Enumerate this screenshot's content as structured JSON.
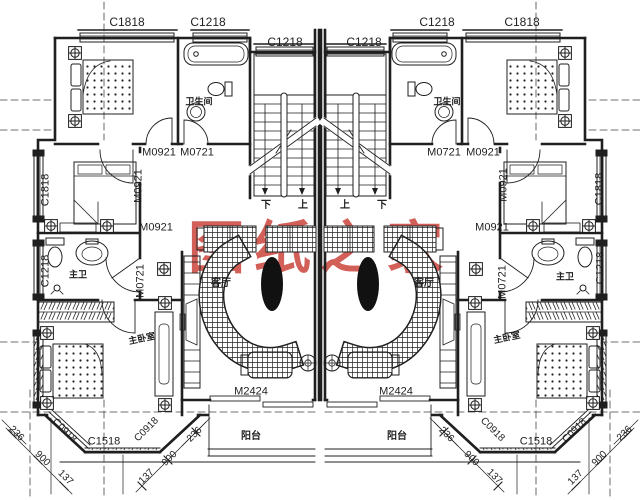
{
  "title": "二层双拼别墅户型平面图",
  "colors": {
    "line": "#1f1f1f",
    "watermark": "#c8392f",
    "background": "#ffffff"
  },
  "annotations": {
    "watermark": [
      {
        "name": "watermark-text",
        "text": "图纸之家",
        "x": 320,
        "y": 249,
        "size": 57,
        "color": "#c8392f",
        "cls": "wm"
      }
    ],
    "windows": [
      {
        "name": "window-code",
        "text": "C1818",
        "x": 127,
        "y": 22,
        "size": 12,
        "cls": "code"
      },
      {
        "name": "window-code",
        "text": "C1218",
        "x": 208,
        "y": 22,
        "size": 12,
        "cls": "code"
      },
      {
        "name": "window-code",
        "text": "C1218",
        "x": 285,
        "y": 42,
        "size": 12,
        "cls": "code"
      },
      {
        "name": "window-code",
        "text": "C1218",
        "x": 364,
        "y": 42,
        "size": 12,
        "cls": "code"
      },
      {
        "name": "window-code",
        "text": "C1218",
        "x": 437,
        "y": 22,
        "size": 12,
        "cls": "code"
      },
      {
        "name": "window-code",
        "text": "C1818",
        "x": 522,
        "y": 22,
        "size": 12,
        "cls": "code"
      },
      {
        "name": "window-code",
        "text": "C1818",
        "x": 46,
        "y": 190,
        "size": 11,
        "rot": -90,
        "cls": "code"
      },
      {
        "name": "window-code",
        "text": "C1818",
        "x": 600,
        "y": 189,
        "size": 11,
        "rot": -90,
        "cls": "code"
      },
      {
        "name": "window-code",
        "text": "C1218",
        "x": 46,
        "y": 271,
        "size": 11,
        "rot": -90,
        "cls": "code"
      },
      {
        "name": "window-code",
        "text": "C1218",
        "x": 601,
        "y": 268,
        "size": 11,
        "rot": -90,
        "cls": "code"
      },
      {
        "name": "window-code",
        "text": "C0918",
        "x": 64,
        "y": 431,
        "size": 10,
        "rot": 45,
        "cls": "code"
      },
      {
        "name": "window-code",
        "text": "C1518",
        "x": 104,
        "y": 442,
        "size": 11,
        "cls": "code"
      },
      {
        "name": "window-code",
        "text": "C0918",
        "x": 147,
        "y": 430,
        "size": 10,
        "rot": -45,
        "cls": "code"
      },
      {
        "name": "window-code",
        "text": "C0918",
        "x": 492,
        "y": 430,
        "size": 10,
        "rot": 45,
        "cls": "code"
      },
      {
        "name": "window-code",
        "text": "C1518",
        "x": 536,
        "y": 442,
        "size": 11,
        "cls": "code"
      },
      {
        "name": "window-code",
        "text": "C0918",
        "x": 575,
        "y": 431,
        "size": 10,
        "rot": -45,
        "cls": "code"
      }
    ],
    "doors": [
      {
        "name": "door-code",
        "text": "M0921",
        "x": 159,
        "y": 153,
        "size": 11,
        "cls": "code"
      },
      {
        "name": "door-code",
        "text": "M0721",
        "x": 197,
        "y": 153,
        "size": 11,
        "cls": "code"
      },
      {
        "name": "door-code",
        "text": "M0721",
        "x": 444,
        "y": 153,
        "size": 11,
        "cls": "code"
      },
      {
        "name": "door-code",
        "text": "M0921",
        "x": 483,
        "y": 153,
        "size": 11,
        "cls": "code"
      },
      {
        "name": "door-code",
        "text": "M0921",
        "x": 139,
        "y": 186,
        "size": 11,
        "rot": -90,
        "cls": "code"
      },
      {
        "name": "door-code",
        "text": "M0921",
        "x": 504,
        "y": 185,
        "size": 11,
        "rot": -90,
        "cls": "code"
      },
      {
        "name": "door-code",
        "text": "M0921",
        "x": 156,
        "y": 228,
        "size": 11,
        "cls": "code"
      },
      {
        "name": "door-code",
        "text": "M0921",
        "x": 492,
        "y": 228,
        "size": 11,
        "cls": "code"
      },
      {
        "name": "door-code",
        "text": "M0721",
        "x": 141,
        "y": 281,
        "size": 11,
        "rot": -90,
        "cls": "code"
      },
      {
        "name": "door-code",
        "text": "M0721",
        "x": 503,
        "y": 282,
        "size": 11,
        "rot": -90,
        "cls": "code"
      },
      {
        "name": "door-code",
        "text": "M2424",
        "x": 251,
        "y": 392,
        "size": 11,
        "cls": "code"
      },
      {
        "name": "door-code",
        "text": "M2424",
        "x": 396,
        "y": 392,
        "size": 11,
        "cls": "code"
      }
    ],
    "rooms": [
      {
        "name": "room-label-bathroom",
        "text": "卫生间",
        "x": 199,
        "y": 102,
        "size": 9,
        "cls": "room"
      },
      {
        "name": "room-label-bathroom",
        "text": "卫生间",
        "x": 447,
        "y": 102,
        "size": 9,
        "cls": "room"
      },
      {
        "name": "room-label-living",
        "text": "客厅",
        "x": 221,
        "y": 284,
        "size": 10,
        "cls": "room"
      },
      {
        "name": "room-label-living",
        "text": "客厅",
        "x": 424,
        "y": 284,
        "size": 10,
        "cls": "room"
      },
      {
        "name": "room-label-masterbath",
        "text": "主卫",
        "x": 78,
        "y": 275,
        "size": 9,
        "cls": "room"
      },
      {
        "name": "room-label-masterbath",
        "text": "主卫",
        "x": 565,
        "y": 277,
        "size": 9,
        "cls": "room"
      },
      {
        "name": "room-label-masterbed",
        "text": "主卧室",
        "x": 142,
        "y": 339,
        "size": 9,
        "rot": -12,
        "cls": "room"
      },
      {
        "name": "room-label-masterbed",
        "text": "主卧室",
        "x": 507,
        "y": 338,
        "size": 9,
        "rot": -12,
        "cls": "room"
      },
      {
        "name": "room-label-balcony",
        "text": "阳台",
        "x": 251,
        "y": 437,
        "size": 10,
        "cls": "room"
      },
      {
        "name": "room-label-balcony",
        "text": "阳台",
        "x": 397,
        "y": 437,
        "size": 10,
        "cls": "room"
      }
    ],
    "stairs": [
      {
        "name": "stair-direction-down",
        "text": "下",
        "x": 266,
        "y": 206,
        "size": 10,
        "cls": "room"
      },
      {
        "name": "stair-direction-up",
        "text": "上",
        "x": 303,
        "y": 206,
        "size": 10,
        "cls": "room"
      },
      {
        "name": "stair-direction-up",
        "text": "上",
        "x": 345,
        "y": 206,
        "size": 10,
        "cls": "room"
      },
      {
        "name": "stair-direction-down",
        "text": "下",
        "x": 382,
        "y": 206,
        "size": 10,
        "cls": "room"
      }
    ],
    "dimensions": [
      {
        "name": "dim-value",
        "text": "236",
        "x": 16,
        "y": 434,
        "size": 10,
        "rot": 45,
        "cls": "dim"
      },
      {
        "name": "dim-value",
        "text": "900",
        "x": 42,
        "y": 459,
        "size": 10,
        "rot": 45,
        "cls": "dim"
      },
      {
        "name": "dim-value",
        "text": "137",
        "x": 65,
        "y": 478,
        "size": 10,
        "rot": 45,
        "cls": "dim"
      },
      {
        "name": "dim-value",
        "text": "137",
        "x": 147,
        "y": 477,
        "size": 10,
        "rot": -45,
        "cls": "dim"
      },
      {
        "name": "dim-value",
        "text": "900",
        "x": 170,
        "y": 459,
        "size": 10,
        "rot": -45,
        "cls": "dim"
      },
      {
        "name": "dim-value",
        "text": "236",
        "x": 195,
        "y": 435,
        "size": 10,
        "rot": -45,
        "cls": "dim"
      },
      {
        "name": "dim-value",
        "text": "236",
        "x": 446,
        "y": 435,
        "size": 10,
        "rot": 45,
        "cls": "dim"
      },
      {
        "name": "dim-value",
        "text": "900",
        "x": 471,
        "y": 459,
        "size": 10,
        "rot": 45,
        "cls": "dim"
      },
      {
        "name": "dim-value",
        "text": "137",
        "x": 494,
        "y": 477,
        "size": 10,
        "rot": 45,
        "cls": "dim"
      },
      {
        "name": "dim-value",
        "text": "137",
        "x": 576,
        "y": 478,
        "size": 10,
        "rot": -45,
        "cls": "dim"
      },
      {
        "name": "dim-value",
        "text": "900",
        "x": 600,
        "y": 459,
        "size": 10,
        "rot": -45,
        "cls": "dim"
      },
      {
        "name": "dim-value",
        "text": "236",
        "x": 625,
        "y": 434,
        "size": 10,
        "rot": -45,
        "cls": "dim"
      }
    ]
  }
}
